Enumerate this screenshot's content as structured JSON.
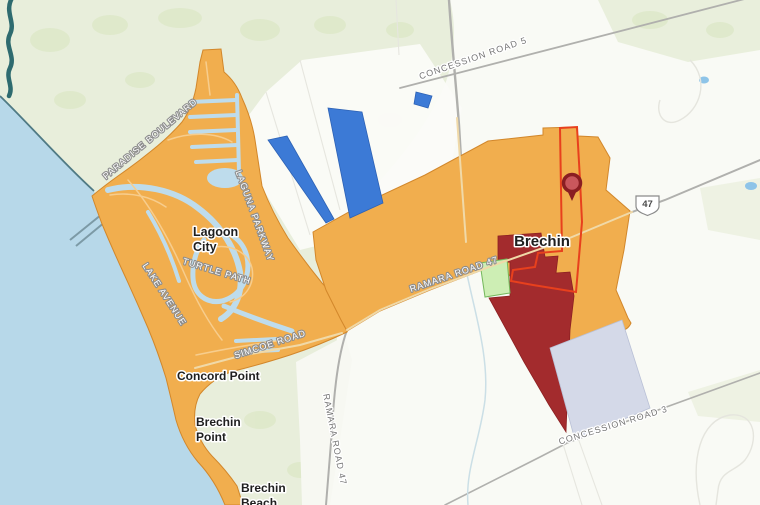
{
  "map": {
    "places": {
      "lagoon_city_line1": "Lagoon",
      "lagoon_city_line2": "City",
      "brechin": "Brechin",
      "concord_point": "Concord Point",
      "brechin_point_line1": "Brechin",
      "brechin_point_line2": "Point",
      "brechin_beach_line1": "Brechin",
      "brechin_beach_line2": "Beach"
    },
    "roads": {
      "concession_road_5": "CONCESSION ROAD 5",
      "concession_road_3": "CONCESSION ROAD 3",
      "ramara_road_47_north_south": "RAMARA ROAD 47",
      "ramara_road_47_east_west": "RAMARA ROAD 47",
      "paradise_boulevard": "PARADISE BOULEVARD",
      "laguna_parkway": "LAGUNA PARKWAY",
      "turtle_path": "TURTLE PATH",
      "lake_avenue": "LAKE AVENUE",
      "simcoe_road": "SIMCOE ROAD"
    },
    "highway_shield": "47",
    "colors": {
      "zoning_orange": "#f1ae4e",
      "zoning_blue": "#3c7ad6",
      "zoning_dark_red": "#a32b2d",
      "zoning_lavender": "#d4d9e8",
      "zoning_light_green": "#cdeeb4",
      "selected_parcel_outline": "#e8401d",
      "pin_fill": "#c9575c",
      "land_green": "#e8eedb",
      "lake_blue": "#b7d8e9",
      "pond_blue": "#8ec4e8"
    }
  }
}
